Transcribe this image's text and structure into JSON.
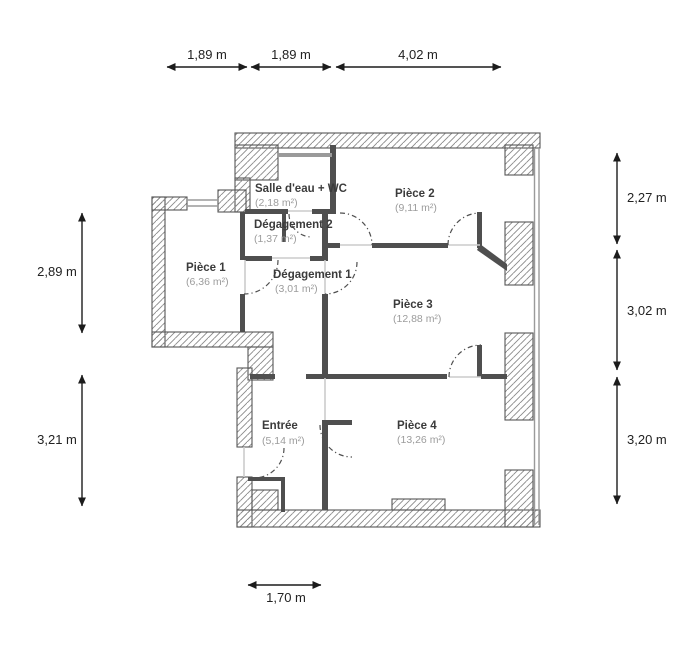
{
  "plan_title": "Apartment floor plan",
  "rooms": {
    "salle_eau": {
      "name": "Salle d'eau + WC",
      "area": "(2,18 m²)"
    },
    "piece2": {
      "name": "Pièce 2",
      "area": "(9,11 m²)"
    },
    "degagement2": {
      "name": "Dégagement 2",
      "area": "(1,37 m²)"
    },
    "piece1": {
      "name": "Pièce 1",
      "area": "(6,36 m²)"
    },
    "degagement1": {
      "name": "Dégagement 1",
      "area": "(3,01 m²)"
    },
    "piece3": {
      "name": "Pièce 3",
      "area": "(12,88 m²)"
    },
    "piece4": {
      "name": "Pièce 4",
      "area": "(13,26 m²)"
    },
    "entree": {
      "name": "Entrée",
      "area": "(5,14 m²)"
    }
  },
  "dimensions": {
    "top": [
      "1,89 m",
      "1,89 m",
      "4,02 m"
    ],
    "left": [
      "2,89 m",
      "3,21 m"
    ],
    "right": [
      "2,27 m",
      "3,02 m",
      "3,20 m"
    ],
    "bottom": [
      "1,70 m"
    ]
  },
  "colors": {
    "wall": "#4f4f4f",
    "hatch_line": "#8a8a8a",
    "room_name_text": "#3b3b3b",
    "room_area_text": "#9c9c9c",
    "dimension_text": "#222222",
    "window": "#9a9a9a",
    "background": "#ffffff"
  }
}
